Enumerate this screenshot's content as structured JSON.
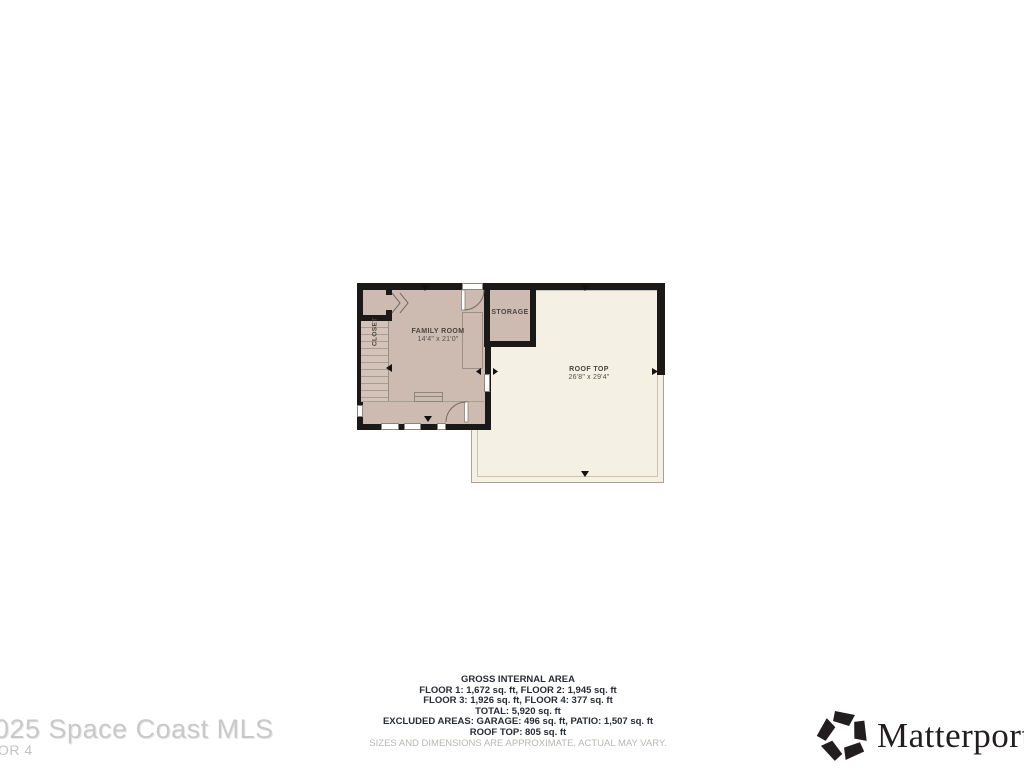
{
  "plan": {
    "rooms": {
      "closet": {
        "label": "CLOSET"
      },
      "family_room": {
        "label": "FAMILY ROOM",
        "dimensions": "14'4\" x 21'0\""
      },
      "storage": {
        "label": "STORAGE"
      },
      "roof_top": {
        "label": "ROOF TOP",
        "dimensions": "26'8\" x 29'4\""
      }
    }
  },
  "area_summary": {
    "title": "GROSS INTERNAL AREA",
    "lines": [
      "FLOOR 1: 1,672 sq. ft, FLOOR 2: 1,945 sq. ft",
      "FLOOR 3: 1,926 sq. ft, FLOOR 4: 377 sq. ft",
      "TOTAL: 5,920 sq. ft",
      "EXCLUDED AREAS: GARAGE: 496 sq. ft, PATIO: 1,507 sq. ft",
      "ROOF TOP: 805 sq. ft"
    ],
    "disclaimer": "SIZES AND DIMENSIONS ARE APPROXIMATE, ACTUAL MAY VARY."
  },
  "watermark": {
    "line1": "025 Space Coast MLS",
    "line2": "OR 4"
  },
  "branding": {
    "wordmark": "Matterport",
    "registered_mark": "®"
  },
  "colors": {
    "room_fill": "#cdbbb1",
    "stairs_fill": "#d3c3b8",
    "roof_fill": "#f4f0e3",
    "wall": "#1b1917",
    "thin_line": "#a79d91",
    "stats_text": "#272b34",
    "disclaimer_text": "#b9b7b3",
    "watermark_text": "#c9c9c9",
    "logo_color": "#221e1f"
  }
}
